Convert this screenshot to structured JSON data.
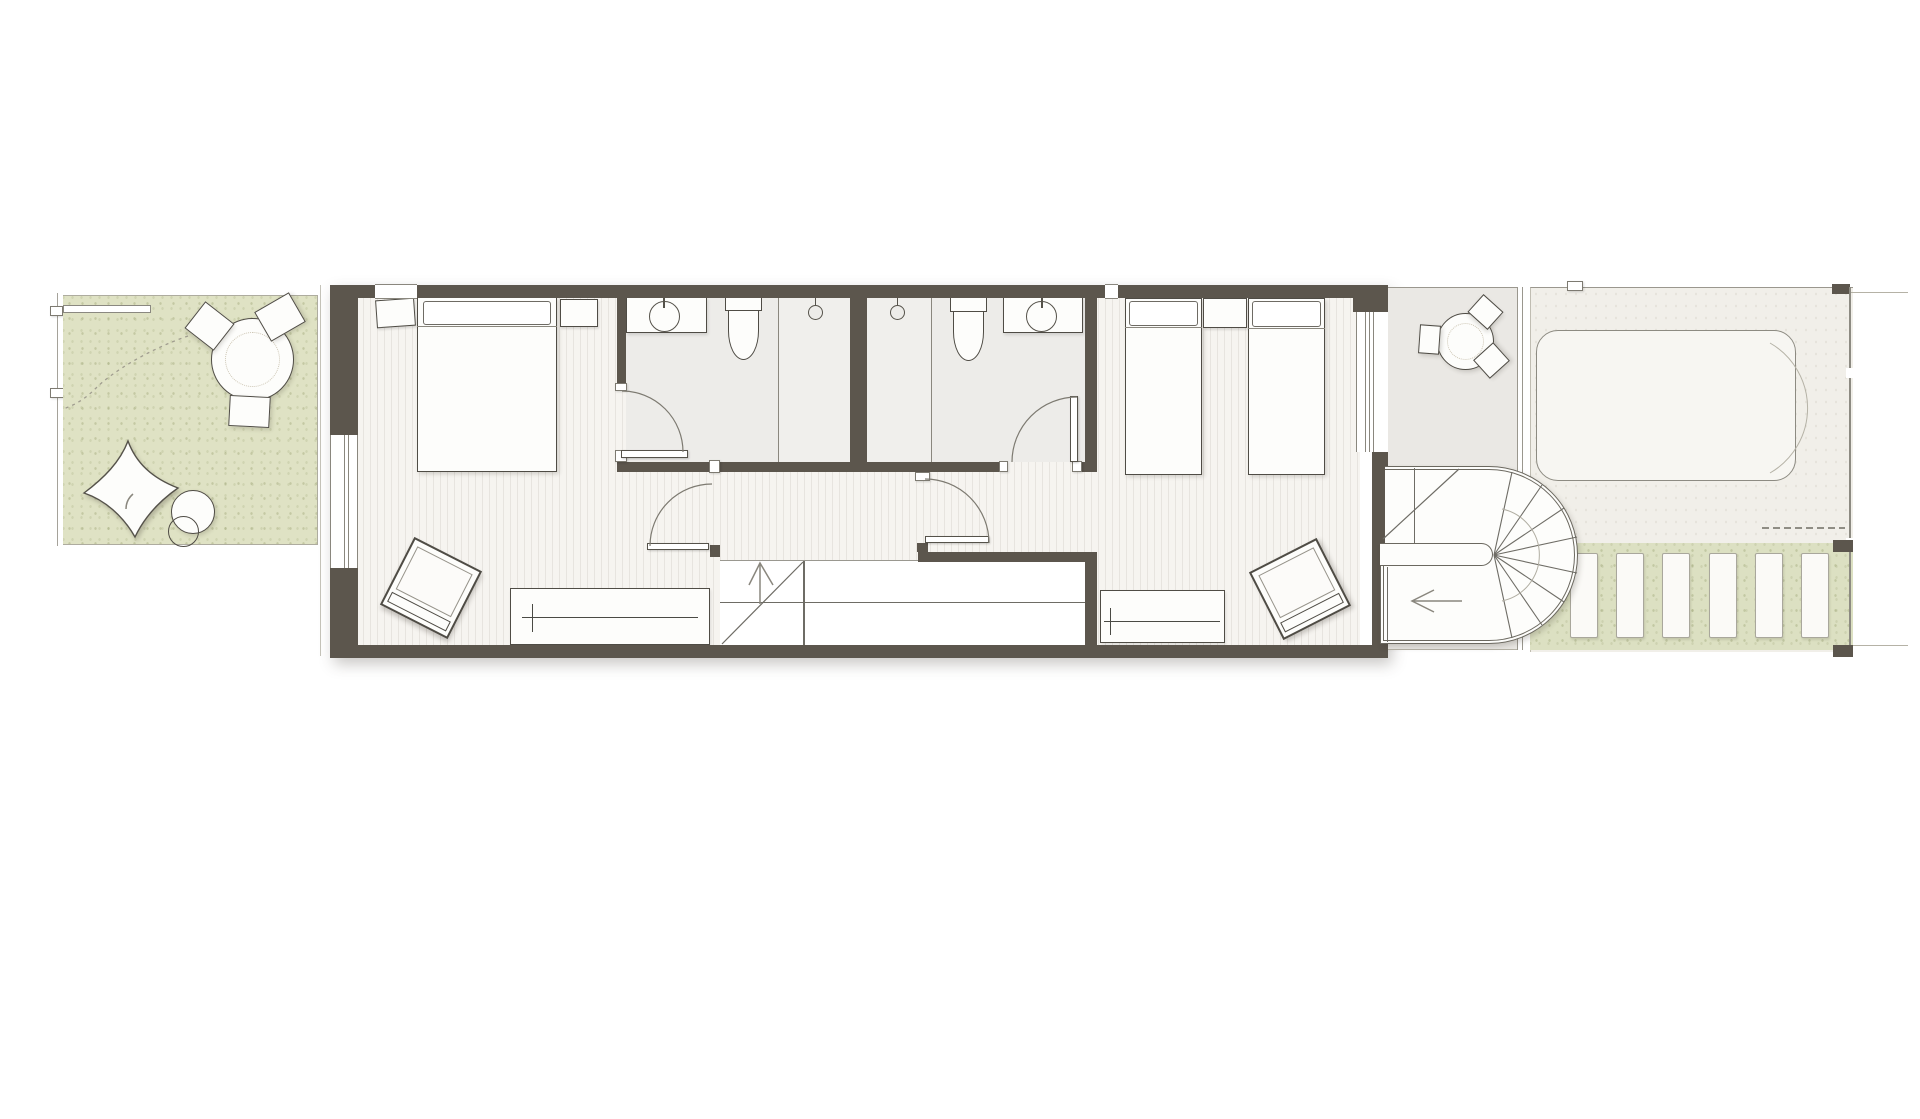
{
  "document": {
    "kind": "architectural-floor-plan",
    "visible_text": [],
    "notes": "upper floor plan of a narrow townhouse: garden terrace left, two bedrooms and two bathrooms with central corridor and straight stair, rear terrace with winder stair, rear deck with pool and slatted path"
  },
  "palette": {
    "wall": "#5c564d",
    "line_strong": "#55524a",
    "line": "#75726a",
    "line_thin": "#a5a29a",
    "floor": "#f6f4f0",
    "floor_stripe": "#e7e4df",
    "bath_floor": "#edece9",
    "terrace_floor": "#eae8e4",
    "deck_floor": "#f1efe9",
    "lawn_green": "#dfe2c4",
    "band_green": "#dce0c2",
    "furniture_fill": "#fdfdfb",
    "furniture_border": "#4f4c45"
  },
  "counts": {
    "main_stair_treads": 12,
    "spiral_top_treads": 4,
    "spiral_bottom_treads": 5,
    "deck_slats": 6,
    "wardrobe_left_ticks": 12,
    "wardrobe_right_ticks": 9,
    "garden_chairs": 3,
    "terrace_chairs": 3
  }
}
